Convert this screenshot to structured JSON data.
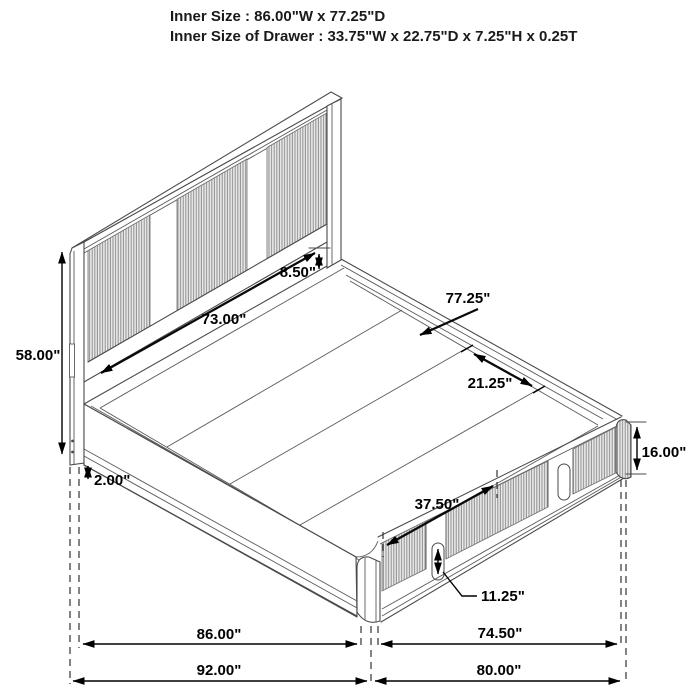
{
  "header": {
    "line1": "Inner Size : 86.00\"W x 77.25\"D",
    "line2": "Inner Size of Drawer : 33.75\"W x 22.75\"D x 7.25\"H x 0.25T"
  },
  "diagram_title": "storage-bed-dimension-diagram",
  "dims": {
    "headboard_height": "58.00\"",
    "headboard_panel_width": "73.00\"",
    "headboard_gap": "8.50\"",
    "bed_depth": "77.25\"",
    "slat_ledge": "21.25\"",
    "base_height": "16.00\"",
    "leg_height": "2.00\"",
    "drawer_span": "37.50\"",
    "drawer_handle": "11.25\"",
    "side_inner": "86.00\"",
    "foot_inner": "74.50\"",
    "side_outer": "92.00\"",
    "foot_outer": "80.00\""
  },
  "colors": {
    "line": "#4a4a4a",
    "dimension": "#000000",
    "flute_line": "#8f8f8f",
    "flute_bg": "#e9e9e9",
    "background": "#ffffff"
  }
}
